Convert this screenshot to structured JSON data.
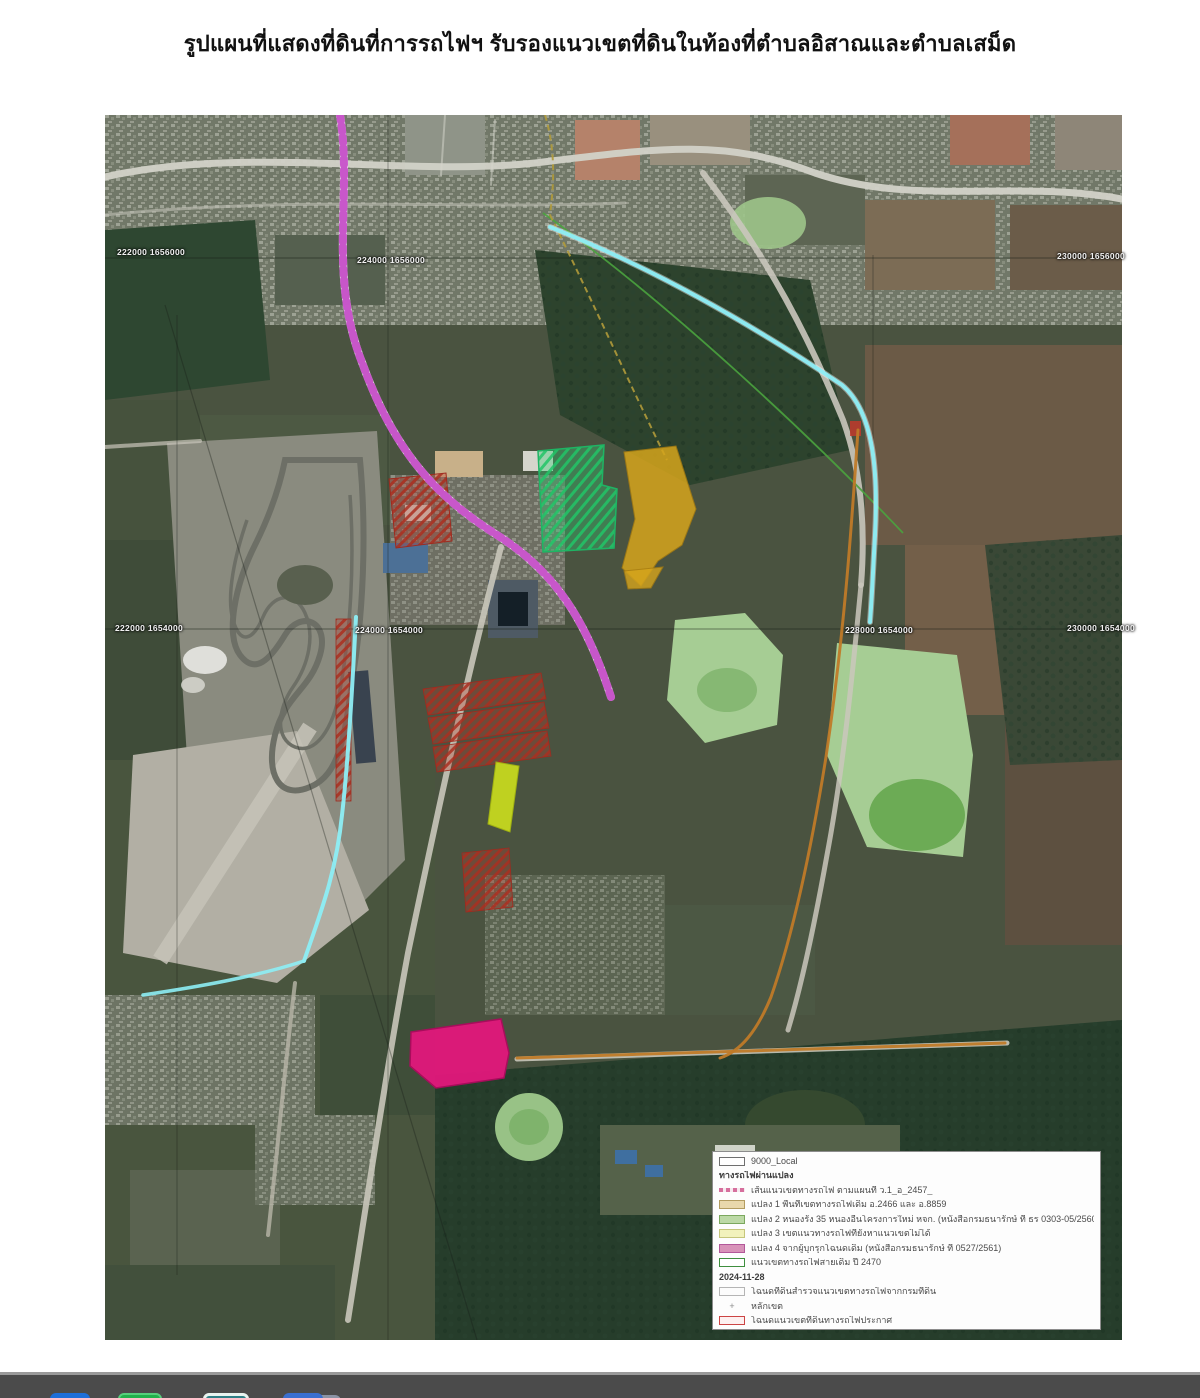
{
  "page": {
    "title": "รูปแผนที่แสดงที่ดินที่การรถไฟฯ รับรองแนวเขตที่ดินในท้องที่ตำบลอิสาณและตำบลเสม็ด"
  },
  "map": {
    "description": "ภาพถ่ายดาวเทียมบริเวณตำบลอิสาณและตำบลเสม็ด จังหวัดบุรีรัมย์ พร้อมแนวเขตที่ดินการรถไฟฯ",
    "grid_labels": [
      {
        "text": "222000 1656000"
      },
      {
        "text": "224000 1656000"
      },
      {
        "text": "230000 1656000"
      },
      {
        "text": "222000 1654000"
      },
      {
        "text": "224000 1654000"
      },
      {
        "text": "228000 1654000"
      },
      {
        "text": "230000 1654000"
      }
    ]
  },
  "legend": {
    "items": [
      {
        "swatch": "white-box",
        "label": "9000_Local"
      },
      {
        "swatch": "none",
        "label": "ทางรถไฟผ่านแปลง"
      },
      {
        "swatch": "pink-dash",
        "label": "เส้นแนวเขตทางรถไฟ ตามแผนที่ ว.1_อ_2457_"
      },
      {
        "swatch": "tan",
        "label": "แปลง 1 พื้นที่เขตทางรถไฟเดิม อ.2466 และ อ.8859"
      },
      {
        "swatch": "green",
        "label": "แปลง 2 หนองรัง 35 หนองอื่นโครงการใหม่ หจก. (หนังสือกรมธนารักษ์ ที่ ธร 0303-05/2560)"
      },
      {
        "swatch": "yellow",
        "label": "แปลง 3 เขตแนวทางรถไฟที่ยังหาแนวเขตไม่ได้"
      },
      {
        "swatch": "pink",
        "label": "แปลง 4 จากผู้บุกรุกโฉนดเดิม (หนังสือกรมธนารักษ์ ที่ 0527/2561)"
      },
      {
        "swatch": "green-border",
        "label": "แนวเขตทางรถไฟสายเดิม ปี 2470"
      },
      {
        "swatch": "none",
        "label": "2024-11-28"
      },
      {
        "swatch": "plain",
        "label": "โฉนดที่ดินสำรวจแนวเขตทางรถไฟจากกรมที่ดิน"
      },
      {
        "swatch": "plus",
        "label": "หลักเขต"
      },
      {
        "swatch": "red-border",
        "label": "โฉนดแนวเขตที่ดินทางรถไฟประกาศ"
      }
    ],
    "plus_glyph": "+"
  },
  "colors": {
    "railway_line": "#c23fc4",
    "boundary_cyan": "#8deef5",
    "survey_orange": "#bf7a28",
    "parcel_green": "#1fb464",
    "parcel_gold": "#d6a51c",
    "parcel_red": "#b03225",
    "parcel_yellowgreen": "#ccdf1d",
    "parcel_pink": "#e2187c",
    "lake_green": "#a6cd94",
    "taskbar": "#4b4b4b"
  },
  "taskbar": {
    "icons": [
      {
        "name": "blue-app"
      },
      {
        "name": "green-app"
      },
      {
        "name": "teal-app"
      },
      {
        "name": "blue-doc-app"
      }
    ]
  }
}
